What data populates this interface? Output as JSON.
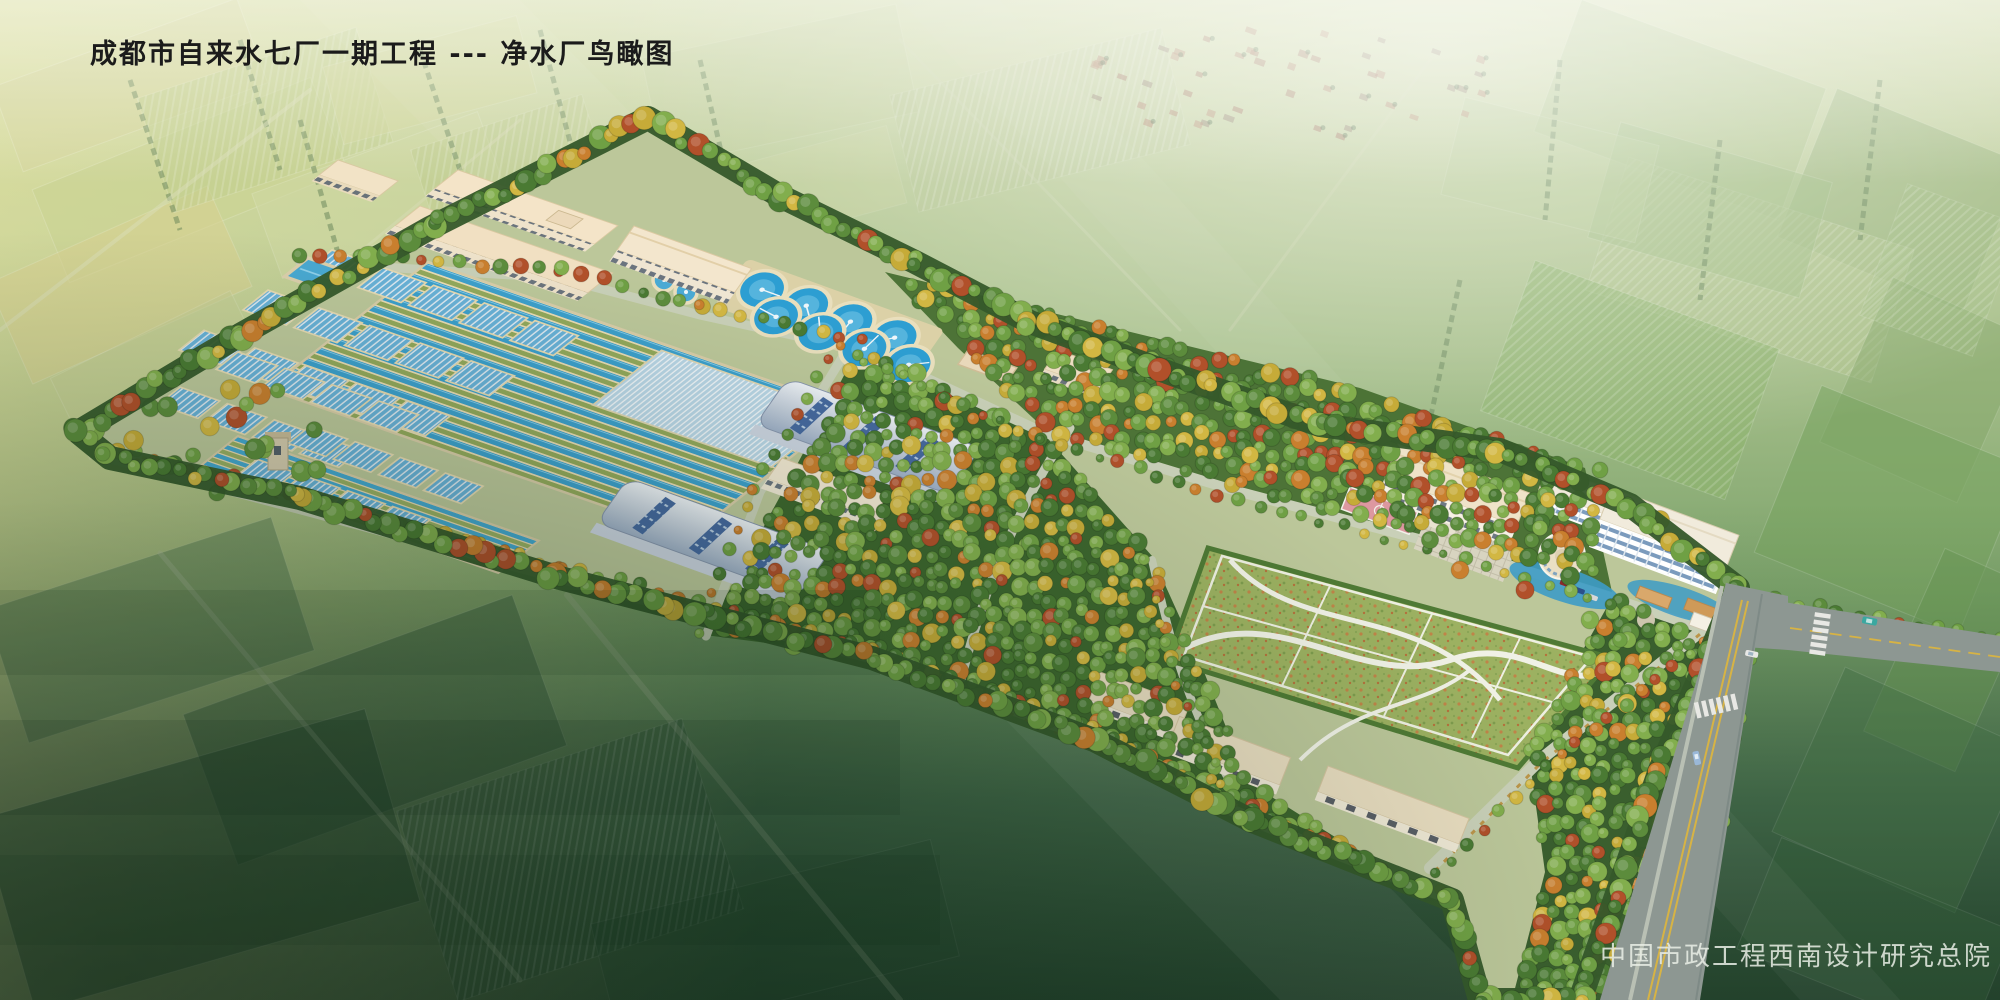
{
  "title": "成都市自来水七厂一期工程 --- 净水厂鸟瞰图",
  "watermark": "中国市政工程西南设计研究总院",
  "scene": {
    "type": "architectural aerial rendering (bird's-eye view)",
    "subject": "water purification plant campus surrounded by farmland",
    "visible_features": [
      "rows of open sedimentation channels with blue water",
      "covered rectangular basins with striped blue covers",
      "eight circular clarifier tanks in two rows",
      "two arched silver-blue roofed process buildings",
      "long beige workshop buildings along north edge",
      "dense orchard / tree blocks",
      "large lawn with white curved paths and grid",
      "office building with pink sports court",
      "white multi-story administration building with round pavilion and pools",
      "garage rows along south edge",
      "perimeter tree belt",
      "two-lane road with double yellow line, crosswalks and cars",
      "hazy farmland background with distant village"
    ]
  },
  "palette": {
    "water_blue": "#3da0cc",
    "clarifier_blue": "#2d9ed2",
    "basin_wall_beige": "#e9dcb4",
    "roof_beige": "#f1e0c2",
    "arched_roof_blue": "#9eafc6",
    "glass_strip_blue": "#46699f",
    "tree_green": "#4a7a33",
    "autumn_yellow": "#c6ab38",
    "autumn_orange": "#c97f2e",
    "lawn_green": "#9cb161",
    "road_gray": "#8d9792",
    "center_line_yellow": "#d7b344",
    "court_pink": "#dd98a0",
    "field_yellow": "#d6d79e",
    "dark_field_green": "#2d4b35"
  }
}
